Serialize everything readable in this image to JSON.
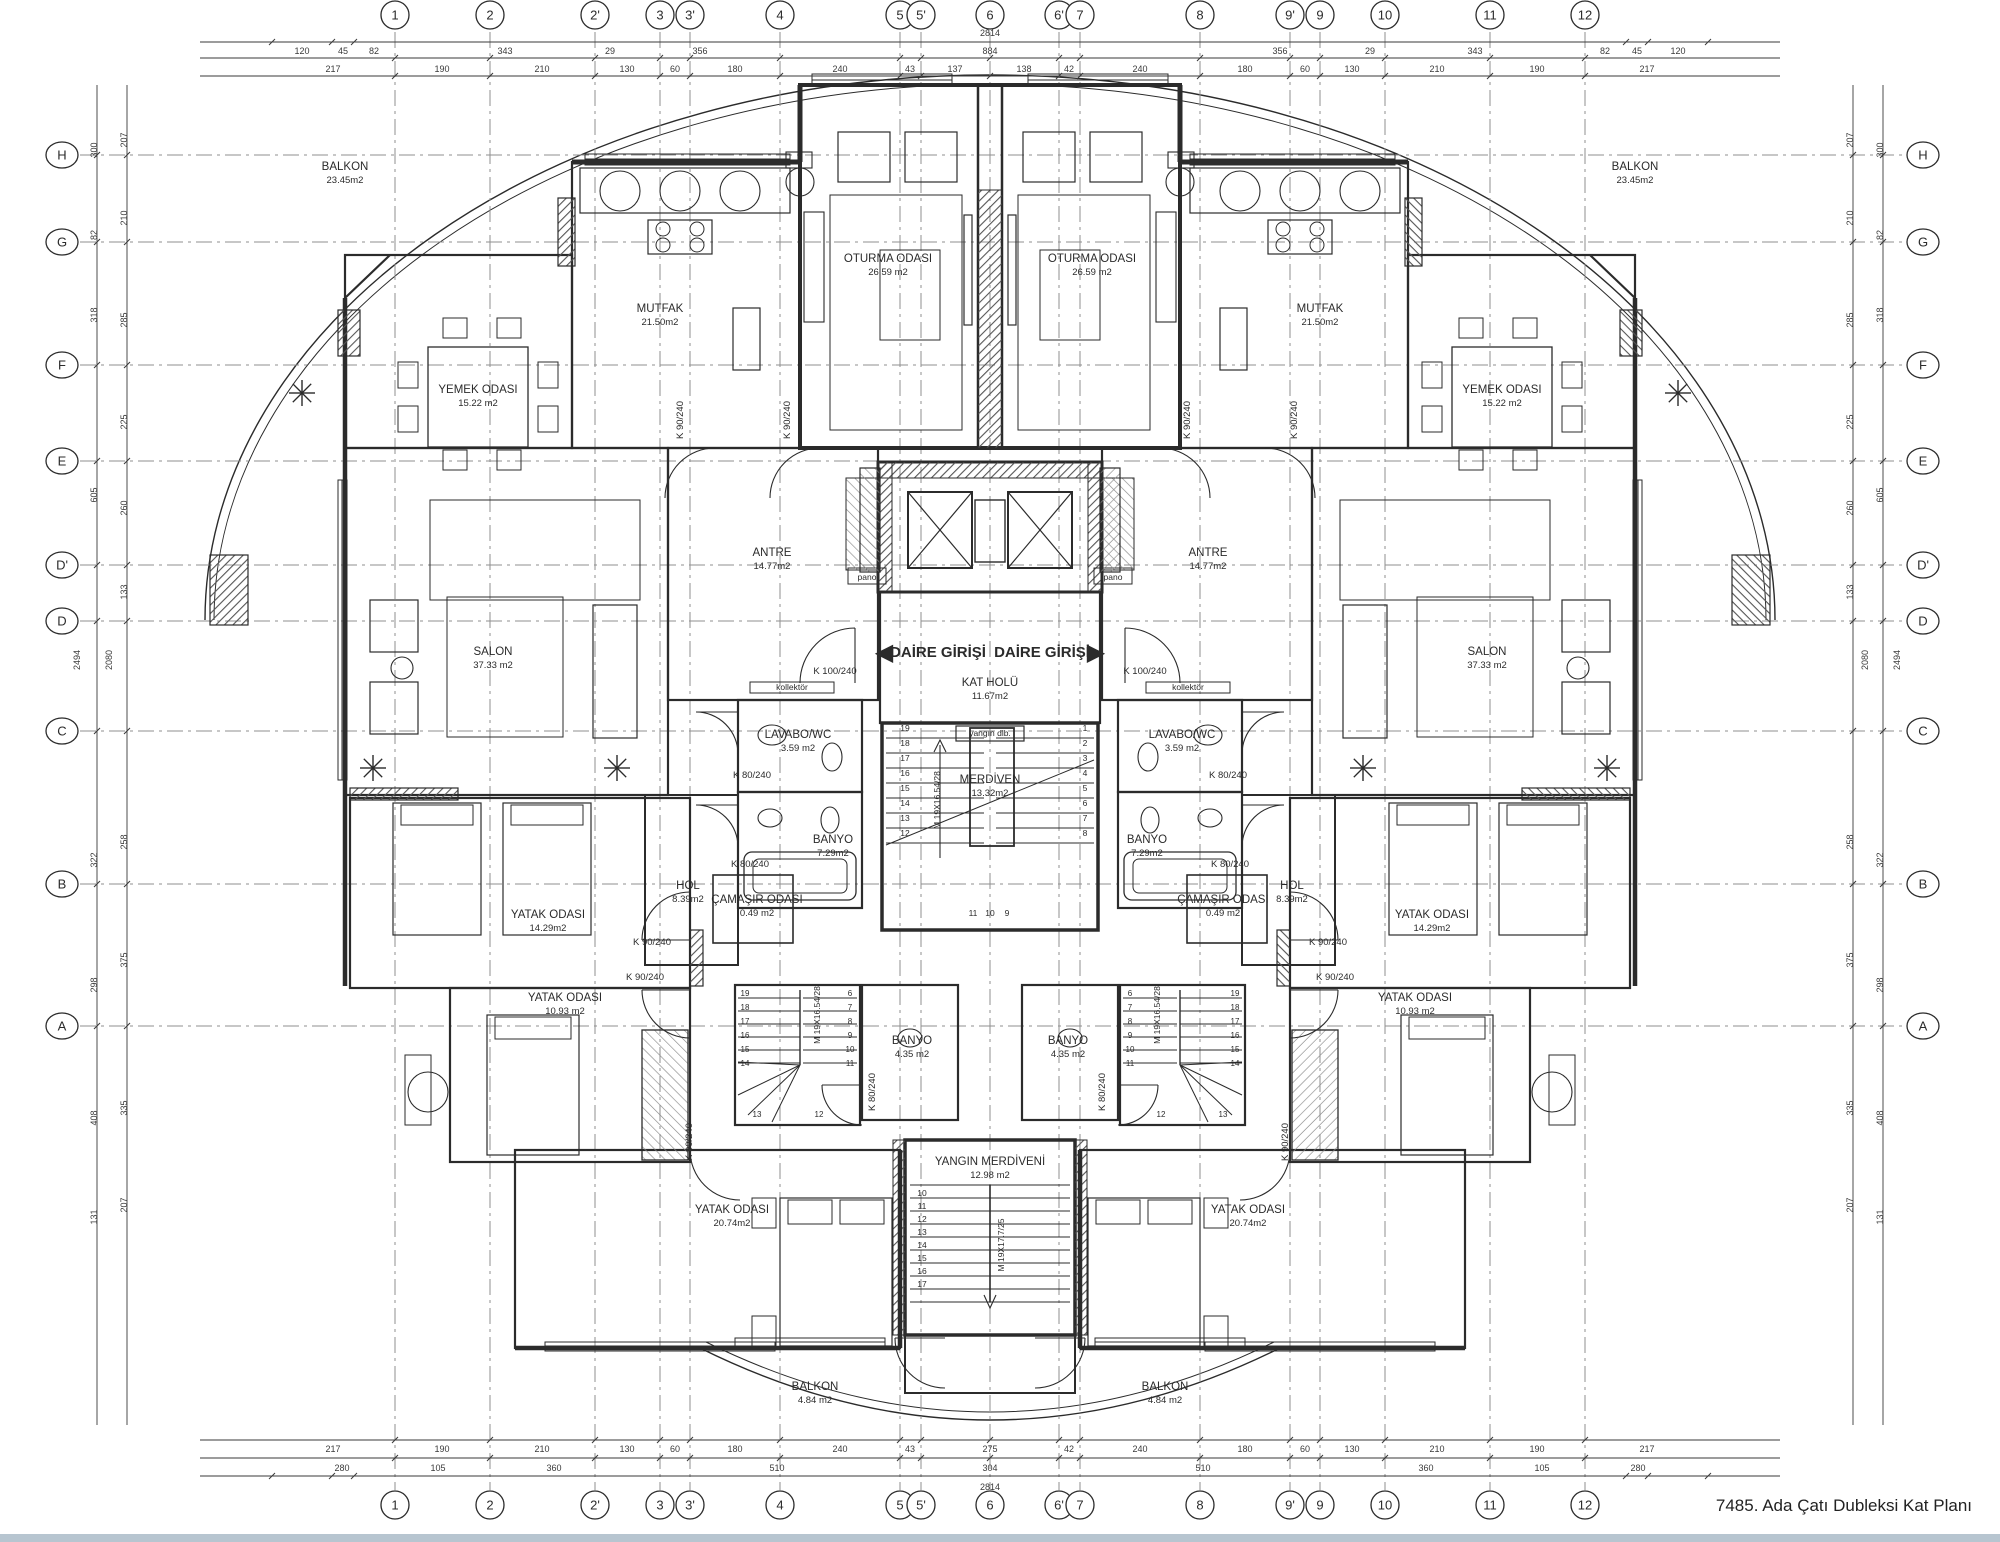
{
  "title": "7485. Ada Çatı Dubleksi Kat Planı",
  "colors": {
    "line": "#2b2b2b",
    "grid": "#8f8f8f",
    "dim": "#3a3a3a",
    "footer_bar": "#b7c5d0",
    "hatch": "#555555"
  },
  "grid": {
    "columns": [
      {
        "label": "1",
        "x": 395
      },
      {
        "label": "2",
        "x": 490
      },
      {
        "label": "2'",
        "x": 595
      },
      {
        "label": "3",
        "x": 660
      },
      {
        "label": "3'",
        "x": 690
      },
      {
        "label": "4",
        "x": 780
      },
      {
        "label": "5",
        "x": 900
      },
      {
        "label": "5'",
        "x": 921
      },
      {
        "label": "6",
        "x": 990
      },
      {
        "label": "6'",
        "x": 1059
      },
      {
        "label": "7",
        "x": 1080
      },
      {
        "label": "8",
        "x": 1200
      },
      {
        "label": "9'",
        "x": 1290
      },
      {
        "label": "9",
        "x": 1320
      },
      {
        "label": "10",
        "x": 1385
      },
      {
        "label": "11",
        "x": 1490
      },
      {
        "label": "12",
        "x": 1585
      }
    ],
    "rows": [
      {
        "label": "H",
        "y": 155
      },
      {
        "label": "G",
        "y": 242
      },
      {
        "label": "F",
        "y": 365
      },
      {
        "label": "E",
        "y": 461
      },
      {
        "label": "D'",
        "y": 565
      },
      {
        "label": "D",
        "y": 621
      },
      {
        "label": "C",
        "y": 731
      },
      {
        "label": "B",
        "y": 884
      },
      {
        "label": "A",
        "y": 1026
      }
    ]
  },
  "dims": {
    "top_row1": [
      {
        "t": "120",
        "x": 302
      },
      {
        "t": "45",
        "x": 343
      },
      {
        "t": "82",
        "x": 374
      },
      {
        "t": "343",
        "x": 505
      },
      {
        "t": "29",
        "x": 610
      },
      {
        "t": "356",
        "x": 700
      },
      {
        "t": "884",
        "x": 990
      },
      {
        "t": "356",
        "x": 1280
      },
      {
        "t": "29",
        "x": 1370
      },
      {
        "t": "343",
        "x": 1475
      },
      {
        "t": "82",
        "x": 1605
      },
      {
        "t": "45",
        "x": 1637
      },
      {
        "t": "120",
        "x": 1678
      }
    ],
    "top_total": {
      "t": "2814",
      "x": 990,
      "y": 36
    },
    "top_row2": [
      {
        "t": "217",
        "x": 333
      },
      {
        "t": "190",
        "x": 442
      },
      {
        "t": "210",
        "x": 542
      },
      {
        "t": "130",
        "x": 627
      },
      {
        "t": "60",
        "x": 675
      },
      {
        "t": "180",
        "x": 735
      },
      {
        "t": "240",
        "x": 840
      },
      {
        "t": "43",
        "x": 910
      },
      {
        "t": "137",
        "x": 955
      },
      {
        "t": "138",
        "x": 1024
      },
      {
        "t": "42",
        "x": 1069
      },
      {
        "t": "240",
        "x": 1140
      },
      {
        "t": "180",
        "x": 1245
      },
      {
        "t": "60",
        "x": 1305
      },
      {
        "t": "130",
        "x": 1352
      },
      {
        "t": "210",
        "x": 1437
      },
      {
        "t": "190",
        "x": 1537
      },
      {
        "t": "217",
        "x": 1647
      }
    ],
    "bottom_row1": [
      {
        "t": "217",
        "x": 333
      },
      {
        "t": "190",
        "x": 442
      },
      {
        "t": "210",
        "x": 542
      },
      {
        "t": "130",
        "x": 627
      },
      {
        "t": "60",
        "x": 675
      },
      {
        "t": "180",
        "x": 735
      },
      {
        "t": "240",
        "x": 840
      },
      {
        "t": "43",
        "x": 910
      },
      {
        "t": "275",
        "x": 990
      },
      {
        "t": "42",
        "x": 1069
      },
      {
        "t": "240",
        "x": 1140
      },
      {
        "t": "180",
        "x": 1245
      },
      {
        "t": "60",
        "x": 1305
      },
      {
        "t": "130",
        "x": 1352
      },
      {
        "t": "210",
        "x": 1437
      },
      {
        "t": "190",
        "x": 1537
      },
      {
        "t": "217",
        "x": 1647
      }
    ],
    "bottom_row2": [
      {
        "t": "280",
        "x": 342
      },
      {
        "t": "105",
        "x": 438
      },
      {
        "t": "360",
        "x": 554
      },
      {
        "t": "510",
        "x": 777
      },
      {
        "t": "304",
        "x": 990
      },
      {
        "t": "510",
        "x": 1203
      },
      {
        "t": "360",
        "x": 1426
      },
      {
        "t": "105",
        "x": 1542
      },
      {
        "t": "280",
        "x": 1638
      }
    ],
    "bottom_total": {
      "t": "2814",
      "x": 990,
      "y": 1490
    },
    "left_colA": {
      "x": 97,
      "items": [
        {
          "t": "300",
          "y": 150
        },
        {
          "t": "82",
          "y": 235
        },
        {
          "t": "318",
          "y": 315
        },
        {
          "t": "605",
          "y": 495
        },
        {
          "t": "322",
          "y": 860
        },
        {
          "t": "298",
          "y": 985
        },
        {
          "t": "408",
          "y": 1118
        },
        {
          "t": "131",
          "y": 1217
        }
      ]
    },
    "left_colB": {
      "x": 127,
      "items": [
        {
          "t": "207",
          "y": 140
        },
        {
          "t": "210",
          "y": 218
        },
        {
          "t": "285",
          "y": 320
        },
        {
          "t": "225",
          "y": 422
        },
        {
          "t": "260",
          "y": 508
        },
        {
          "t": "133",
          "y": 592
        },
        {
          "t": "258",
          "y": 842
        },
        {
          "t": "375",
          "y": 960
        },
        {
          "t": "335",
          "y": 1108
        },
        {
          "t": "207",
          "y": 1205
        }
      ]
    },
    "left_totals": [
      {
        "t": "2494",
        "x": 80,
        "y": 660
      },
      {
        "t": "2080",
        "x": 112,
        "y": 660
      }
    ]
  },
  "rooms": [
    {
      "label": "BALKON",
      "area": "23.45m2",
      "x": 345,
      "y": 170
    },
    {
      "label": "BALKON",
      "area": "23.45m2",
      "x": 1635,
      "y": 170
    },
    {
      "label": "MUTFAK",
      "area": "21.50m2",
      "x": 660,
      "y": 312
    },
    {
      "label": "MUTFAK",
      "area": "21.50m2",
      "x": 1320,
      "y": 312
    },
    {
      "label": "OTURMA ODASI",
      "area": "26.59  m2",
      "x": 888,
      "y": 262
    },
    {
      "label": "OTURMA ODASI",
      "area": "26.59  m2",
      "x": 1092,
      "y": 262
    },
    {
      "label": "YEMEK ODASI",
      "area": "15.22 m2",
      "x": 478,
      "y": 393
    },
    {
      "label": "YEMEK ODASI",
      "area": "15.22 m2",
      "x": 1502,
      "y": 393
    },
    {
      "label": "SALON",
      "area": "37.33 m2",
      "x": 493,
      "y": 655
    },
    {
      "label": "SALON",
      "area": "37.33 m2",
      "x": 1487,
      "y": 655
    },
    {
      "label": "ANTRE",
      "area": "14.77m2",
      "x": 772,
      "y": 556
    },
    {
      "label": "ANTRE",
      "area": "14.77m2",
      "x": 1208,
      "y": 556
    },
    {
      "label": "LAVABO/WC",
      "area": "3.59 m2",
      "x": 798,
      "y": 738
    },
    {
      "label": "LAVABO/WC",
      "area": "3.59 m2",
      "x": 1182,
      "y": 738
    },
    {
      "label": "BANYO",
      "area": "7.29m2",
      "x": 833,
      "y": 843
    },
    {
      "label": "BANYO",
      "area": "7.29m2",
      "x": 1147,
      "y": 843
    },
    {
      "label": "HOL",
      "area": "8.39m2",
      "x": 688,
      "y": 889
    },
    {
      "label": "HOL",
      "area": "8.39m2",
      "x": 1292,
      "y": 889
    },
    {
      "label": "ÇAMAŞIR ODASI",
      "area": "0.49 m2",
      "x": 757,
      "y": 903
    },
    {
      "label": "ÇAMAŞIR ODASI",
      "area": "0.49 m2",
      "x": 1223,
      "y": 903
    },
    {
      "label": "YATAK ODASI",
      "area": "14.29m2",
      "x": 548,
      "y": 918
    },
    {
      "label": "YATAK ODASI",
      "area": "14.29m2",
      "x": 1432,
      "y": 918
    },
    {
      "label": "YATAK ODASI",
      "area": "10.93 m2",
      "x": 565,
      "y": 1001
    },
    {
      "label": "YATAK ODASI",
      "area": "10.93 m2",
      "x": 1415,
      "y": 1001
    },
    {
      "label": "YATAK ODASI",
      "area": "20.74m2",
      "x": 732,
      "y": 1213
    },
    {
      "label": "YATAK ODASI",
      "area": "20.74m2",
      "x": 1248,
      "y": 1213
    },
    {
      "label": "BANYO",
      "area": "4.35 m2",
      "x": 912,
      "y": 1044
    },
    {
      "label": "BANYO",
      "area": "4.35 m2",
      "x": 1068,
      "y": 1044
    },
    {
      "label": "BALKON",
      "area": "4.84 m2",
      "x": 815,
      "y": 1390
    },
    {
      "label": "BALKON",
      "area": "4.84 m2",
      "x": 1165,
      "y": 1390
    },
    {
      "label": "KAT HOLÜ",
      "area": "11.67m2",
      "x": 990,
      "y": 686
    },
    {
      "label": "MERDİVEN",
      "area": "13.32m2",
      "x": 990,
      "y": 783
    },
    {
      "label": "YANGIN MERDİVENİ",
      "area": "12.98 m2",
      "x": 990,
      "y": 1165
    }
  ],
  "entrances": [
    {
      "label": "DAİRE GİRİŞİ",
      "arrow": "◀",
      "ax": 884,
      "x": 938,
      "y": 657
    },
    {
      "label": "DAİRE GİRİŞİ",
      "arrow": "▶",
      "ax": 1096,
      "x": 1042,
      "y": 657
    }
  ],
  "annotations": [
    {
      "t": "K 90/240",
      "x": 683,
      "y": 420,
      "rot": true
    },
    {
      "t": "K 90/240",
      "x": 790,
      "y": 420,
      "rot": true
    },
    {
      "t": "K 90/240",
      "x": 1297,
      "y": 420,
      "rot": true
    },
    {
      "t": "K 90/240",
      "x": 1190,
      "y": 420,
      "rot": true
    },
    {
      "t": "K 100/240",
      "x": 835,
      "y": 674
    },
    {
      "t": "K 100/240",
      "x": 1145,
      "y": 674
    },
    {
      "t": "kollektör",
      "x": 792,
      "y": 690,
      "small": true
    },
    {
      "t": "kollektör",
      "x": 1188,
      "y": 690,
      "small": true
    },
    {
      "t": "pano",
      "x": 867,
      "y": 580,
      "small": true
    },
    {
      "t": "pano",
      "x": 1113,
      "y": 580,
      "small": true
    },
    {
      "t": "K 80/240",
      "x": 752,
      "y": 778
    },
    {
      "t": "K 80/240",
      "x": 1228,
      "y": 778
    },
    {
      "t": "K 80/240",
      "x": 750,
      "y": 867
    },
    {
      "t": "K 80/240",
      "x": 1230,
      "y": 867
    },
    {
      "t": "K 90/240",
      "x": 652,
      "y": 945
    },
    {
      "t": "K 90/240",
      "x": 1328,
      "y": 945
    },
    {
      "t": "K 90/240",
      "x": 645,
      "y": 980
    },
    {
      "t": "K 90/240",
      "x": 1335,
      "y": 980
    },
    {
      "t": "K 90/240",
      "x": 692,
      "y": 1142,
      "rot": true
    },
    {
      "t": "K 90/240",
      "x": 1288,
      "y": 1142,
      "rot": true
    },
    {
      "t": "K 80/240",
      "x": 875,
      "y": 1092,
      "rot": true
    },
    {
      "t": "K 80/240",
      "x": 1105,
      "y": 1092,
      "rot": true
    },
    {
      "t": "M 19X16.54/28",
      "x": 940,
      "y": 800,
      "rot": true,
      "small": true
    },
    {
      "t": "M 19X16.54/28",
      "x": 820,
      "y": 1015,
      "rot": true,
      "small": true
    },
    {
      "t": "M 19X16.54/28",
      "x": 1160,
      "y": 1015,
      "rot": true,
      "small": true
    },
    {
      "t": "M 19X17.7/25",
      "x": 1004,
      "y": 1245,
      "rot": true,
      "small": true
    },
    {
      "t": "yangın dlb.",
      "x": 990,
      "y": 736,
      "small": true
    }
  ],
  "stairs": {
    "main_left": [
      "19",
      "18",
      "17",
      "16",
      "15",
      "14",
      "13",
      "12"
    ],
    "main_right": [
      "1",
      "2",
      "3",
      "4",
      "5",
      "6",
      "7",
      "8"
    ],
    "main_bottom": [
      "11",
      "10",
      "9"
    ],
    "fire": [
      "10",
      "11",
      "12",
      "13",
      "14",
      "15",
      "16",
      "17"
    ],
    "duplex_a": [
      "19",
      "18",
      "17",
      "16",
      "15",
      "14"
    ],
    "duplex_b": [
      "6",
      "7",
      "8",
      "9",
      "10",
      "11"
    ],
    "duplex_c": [
      "13",
      "12"
    ]
  }
}
